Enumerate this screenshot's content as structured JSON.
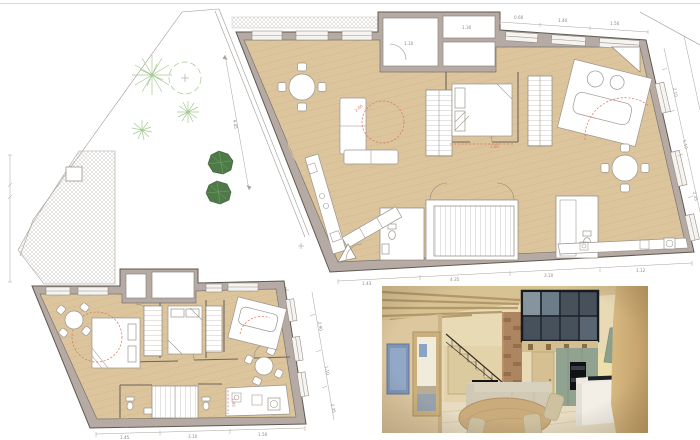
{
  "sheet": {
    "kind": "architectural floor plan sheet with interior render"
  },
  "palette": {
    "wood_floor": "#dcc59d",
    "wood_line": "#cdb288",
    "wall_fill": "#b6aba4",
    "wall_edge": "#5f5951",
    "window_fill": "#f6f4f1",
    "plant_light": "#a5c893",
    "bush_dark": "#4e7a48",
    "bush_edge": "#3e5f3a",
    "bush_light": "#79a36c",
    "red_annotation": "#d9745a",
    "dim_gray": "#8f8a83",
    "ph_wall": "#ddc79f",
    "ph_wall_dark": "#c29e66",
    "ph_ceiling": "#d7c293",
    "ph_beam": "#ab9060",
    "ph_floor": "#e7dcc2",
    "ph_glass": "#46515c",
    "ph_frame": "#171b20",
    "ph_sage": "#91a390",
    "ph_brick": "#ad8561",
    "ph_table": "#c9ab7c",
    "ph_sofa": "#d8d1bd",
    "ph_art": "#7e95b6",
    "ph_island": "#f3efe7"
  },
  "garden": {
    "dim_label": "4.45"
  },
  "upper_plan": {
    "dims_top": [
      "0.60",
      "1.40",
      "1.50"
    ],
    "dims_right": [
      "2.10",
      "1.10",
      "2.35"
    ],
    "dims_bottom": [
      "1.43",
      "4.35",
      "3.10",
      "1.12"
    ],
    "block_labels": [
      "1.10",
      "1.30"
    ],
    "red_notes": [
      "1.60",
      "2.00"
    ]
  },
  "lower_plan": {
    "dims_right": [
      "2.90",
      "1.10",
      "2.35"
    ],
    "dims_bottom": [
      "1.45",
      "3.10",
      "1.50"
    ],
    "red_note": "1.45"
  }
}
